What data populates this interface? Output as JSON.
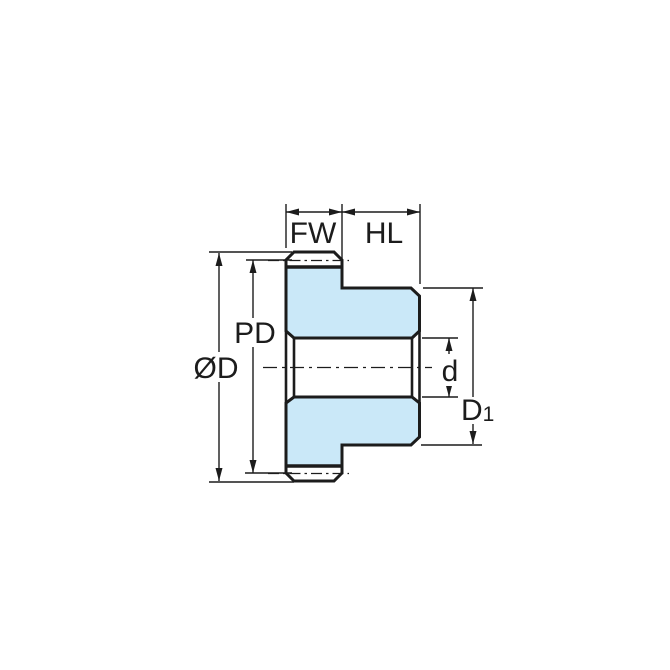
{
  "diagram": {
    "type": "technical-drawing",
    "subject": "spur gear cross-section with dimension callouts",
    "background_color": "#ffffff",
    "line_color": "#1c1c1c",
    "part_fill_color": "#cae8f8",
    "labels": {
      "face_width": "FW",
      "hub_length": "HL",
      "outside_diameter": "ØD",
      "pitch_diameter": "PD",
      "bore_diameter": "d",
      "hub_diameter_base": "D",
      "hub_diameter_subscript": "1"
    }
  }
}
